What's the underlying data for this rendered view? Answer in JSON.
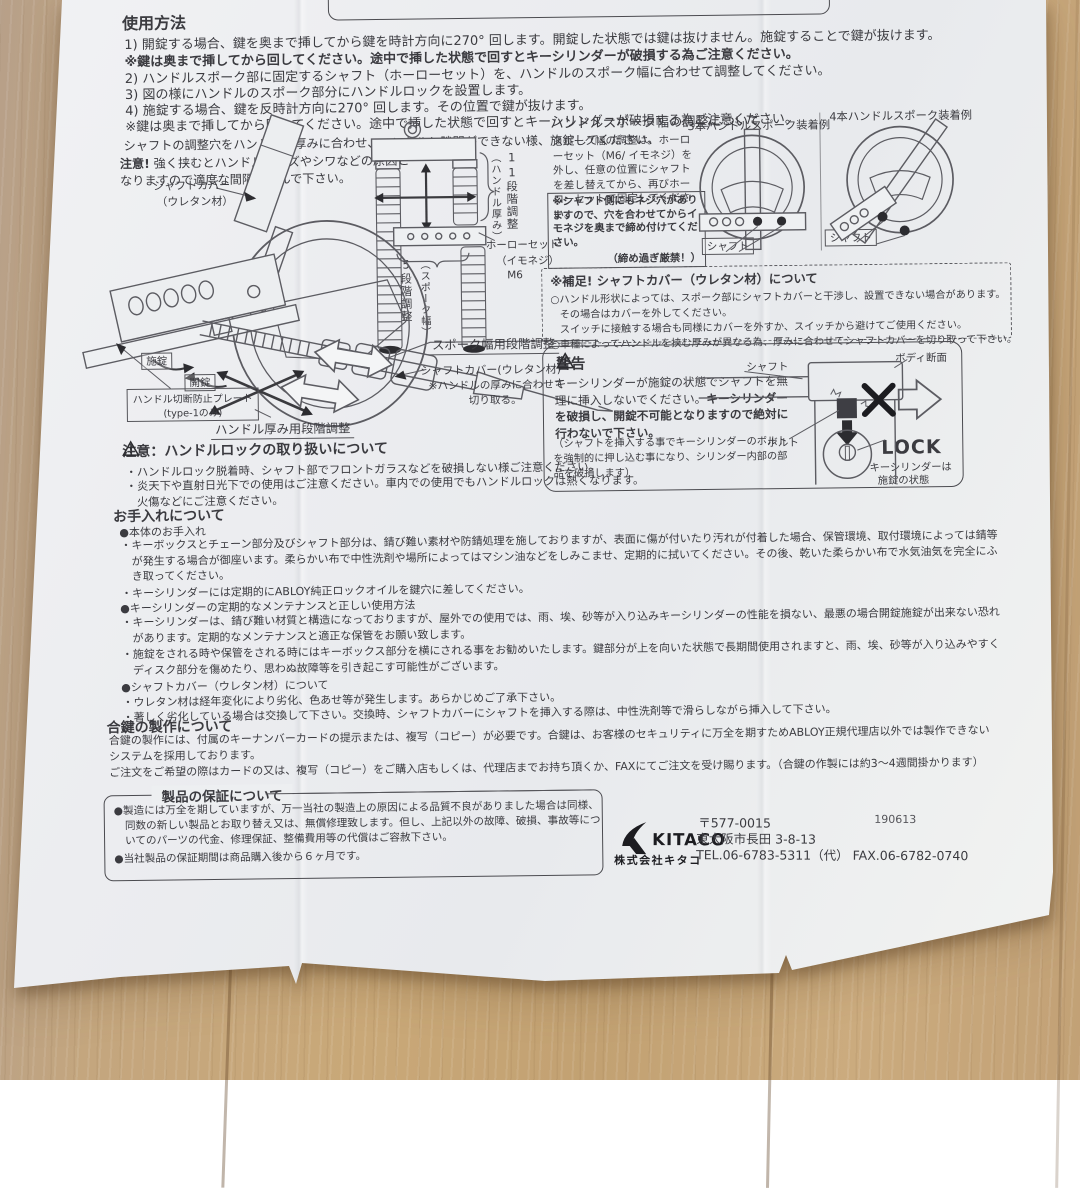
{
  "usage": {
    "title": "使用方法",
    "line1": "1) 開錠する場合、鍵を奥まで挿してから鍵を時計方向に270° 回します。開錠した状態では鍵は抜けません。施錠することで鍵が抜けます。",
    "line2": "※鍵は奥まで挿してから回してください。途中で挿した状態で回すとキーシリンダーが破損する為ご注意ください。",
    "line3": "2) ハンドルスポーク部に固定するシャフト（ホーローセット）を、ハンドルのスポーク幅に合わせて調整してください。",
    "line4": "3) 図の様にハンドルのスポーク部分にハンドルロックを設置します。",
    "line5": "4) 施錠する場合、鍵を反時計方向に270° 回します。その位置で鍵が抜けます。",
    "line6": "※鍵は奥まで挿してから回してください。途中で挿した状態で回すとキーシリンダーが破損する為ご注意ください。",
    "note1": "シャフトの調整穴をハンドルの厚みに合わせ、ハンドルと隙間ができない様、施錠してください。",
    "note2_bold": "注意!",
    "note2a": "強く挟むとハンドルにキズやシワなどの原因と",
    "note2b": "なりますので適度な間隔で挟んで下さい。"
  },
  "spoke": {
    "title": "ハンドルスポーク幅の調整について",
    "body": "スポーク幅の調整は、ホーローセット（M6/ イモネジ）を外し、任意の位置にシャフトを差し替えてから、再びホーローセットで固定してください。",
    "boxed_note": "※シャフト側にもネジ穴がありますので、穴を合わせてからイモネジを奥まで締め付けてください。",
    "boxed_note2": "（締め過ぎ厳禁！）",
    "example3": "3本ハンドルスポーク装着例",
    "example4": "4本ハンドルスポーク装着例",
    "shaft3": "シャフト",
    "shaft4": "シャフト"
  },
  "diagram": {
    "shaft_cover1": "シャフトカバー",
    "shaft_cover2": "（ウレタン材）",
    "lock": "施錠",
    "unlock": "開錠",
    "plate1": "ハンドル切断防止プレート",
    "plate2": "(type-1のみ)",
    "thickness_steps": "ハンドル厚み用段階調整",
    "spoke_steps": "スポーク幅用段階調整",
    "cover_note1": "シャフトカバー(ウレタン材)",
    "cover_note2": "※ハンドルの厚みに合わせて",
    "cover_note3": "切り取る。",
    "eleven": "11段階調整",
    "eleven_p": "（ハンドル厚み）",
    "five": "5段階調整",
    "five_p": "（スポーク幅）",
    "holo1": "ホーローセット",
    "holo2": "（イモネジ）",
    "holo3": "M6"
  },
  "supplement": {
    "title": "※補足! シャフトカバー（ウレタン材）について",
    "l1": "○ハンドル形状によっては、スポーク部にシャフトカバーと干渉し、設置できない場合があります。",
    "l2": "その場合はカバーを外してください。",
    "l3": "スイッチに接触する場合も同様にカバーを外すか、スイッチから避けてご使用ください。",
    "l4": "○車種によってハンドルを挟む厚みが異なる為、厚みに合わせてシャフトカバーを切り取って下さい。"
  },
  "warning": {
    "title": "警告",
    "b1": "キーシリンダーが施錠の状態でシャフトを無理に挿入しないでください。",
    "b2": "キーシリンダーを破損し、開錠不可能となりますので絶対に行わないで下さい。",
    "paren": "（シャフトを挿入する事でキーシリンダーのボルトを強制的に押し込む事になり、シリンダー内部の部品を破損します）",
    "shaft": "シャフト",
    "body_section": "ボディ断面",
    "bolt": "ボルト",
    "lock_big": "LOCK",
    "state1": "キーシリンダーは",
    "state2": "施錠の状態"
  },
  "caution": {
    "title": "注意：ハンドルロックの取り扱いについて",
    "l1": "・ハンドルロック脱着時、シャフト部でフロントガラスなどを破損しない様ご注意ください。",
    "l2": "・炎天下や直射日光下での使用はご注意ください。車内での使用でもハンドルロックは熱くなります。火傷などにご注意ください。"
  },
  "care": {
    "title": "お手入れについて",
    "s1": "●本体のお手入れ",
    "p1": "・キーボックスとチェーン部分及びシャフト部分は、錆び難い素材や防錆処理を施しておりますが、表面に傷が付いたり汚れが付着した場合、保管環境、取付環境によっては錆等が発生する場合が御座います。柔らかい布で中性洗剤や場所によってはマシン油などをしみこませ、定期的に拭いてください。その後、乾いた柔らかい布で水気油気を完全にふき取ってください。",
    "p2": "・キーシリンダーには定期的にABLOY純正ロックオイルを鍵穴に差してください。",
    "s2": "●キーシリンダーの定期的なメンテナンスと正しい使用方法",
    "p3": "・キーシリンダーは、錆び難い材質と構造になっておりますが、屋外での使用では、雨、埃、砂等が入り込みキーシリンダーの性能を損ない、最悪の場合開錠施錠が出来ない恐れがあります。定期的なメンテナンスと適正な保管をお願い致します。",
    "p4": "・施錠をされる時や保管をされる時にはキーボックス部分を横にされる事をお勧めいたします。鍵部分が上を向いた状態で長期間使用されますと、雨、埃、砂等が入り込みやすくディスク部分を傷めたり、思わぬ故障等を引き起こす可能性がございます。",
    "s3": "●シャフトカバー（ウレタン材）について",
    "p5": "・ウレタン材は経年変化により劣化、色あせ等が発生します。あらかじめご了承下さい。",
    "p6": "・著しく劣化している場合は交換して下さい。交換時、シャフトカバーにシャフトを挿入する際は、中性洗剤等で滑らしながら挿入して下さい。"
  },
  "keycopy": {
    "title": "合鍵の製作について",
    "p1": "合鍵の製作には、付属のキーナンバーカードの提示または、複写（コピー）が必要です。合鍵は、お客様のセキュリティに万全を期すためABLOY正規代理店以外では製作できないシステムを採用しております。",
    "p2": "ご注文をご希望の際はカードの又は、複写（コピー）をご購入店もしくは、代理店までお持ち頂くか、FAXにてご注文を受け賜ります。（合鍵の作製には約3～4週間掛かります）"
  },
  "warranty": {
    "title": "製品の保証について",
    "p1": "●製造には万全を期していますが、万一当社の製造上の原因による品質不良がありました場合は同様、同数の新しい製品とお取り替え又は、無償修理致します。但し、上記以外の故障、破損、事故等についてのパーツの代金、修理保証、整備費用等の代償はご容赦下さい。",
    "p2": "●当社製品の保証期間は商品購入後から６ヶ月です。"
  },
  "company": {
    "brand": "KITACO",
    "name": "株式会社キタコ",
    "date_code": "190613",
    "zip": "〒577-0015",
    "address": "東大阪市長田 3-8-13",
    "tel": "TEL.06-6783-5311（代） FAX.06-6782-0740"
  }
}
